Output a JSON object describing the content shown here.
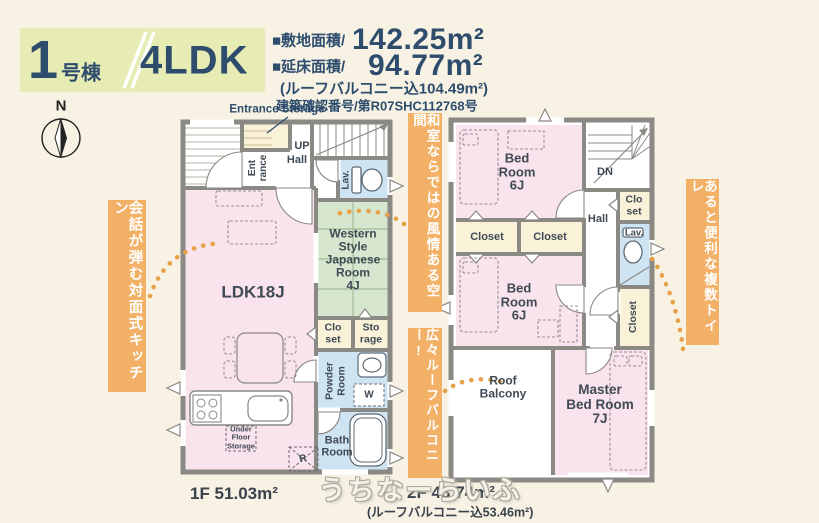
{
  "colors": {
    "background": "#f7f2e4",
    "header_green": "#e7ecb5",
    "navy": "#2e4d6d",
    "room_pink": "#f9e3ed",
    "tatami_green": "#d7e6cf",
    "wet_blue": "#cfe4f3",
    "closet_cream": "#f9f2d9",
    "wall_gray": "#8b8984",
    "banner_orange": "#f2b166",
    "dot_orange": "#e7a149"
  },
  "header": {
    "unit_number": "1",
    "unit_suffix": "号棟",
    "layout": "4LDK",
    "land_label": "■敷地面積/",
    "land_value": "142.25m²",
    "floor_label": "■延床面積/",
    "floor_value": "94.77m²",
    "balcony_note": "(ルーフバルコニー込104.49m²)",
    "permit": "建築確認番号/第R07SHC112768号"
  },
  "compass_label": "N",
  "banners": {
    "kitchen": "会話が弾む対面式キッチン",
    "washitsu": "和室ならではの風情ある空間",
    "balcony": "広々ルーフバルコニー!",
    "toilet": "あると便利な複数トイレ"
  },
  "floor1": {
    "area_label": "1F 51.03m²",
    "labels": {
      "entrance_storage": "Entrance Storage",
      "entrance": "Ent\nrance",
      "up": "UP",
      "hall": "Hall",
      "lav": "Lav.",
      "ldk": "LDK18J",
      "japanese_room": "Western\nStyle\nJapanese\nRoom\n4J",
      "closet": "Clo\nset",
      "storage": "Sto\nrage",
      "powder_room": "Powder\nRoom",
      "washer": "W",
      "bath_room": "Bath\nRoom",
      "under_floor_storage": "Under\nFloor\nStorage",
      "fridge": "R"
    }
  },
  "floor2": {
    "area_label": "2F 43.74m²",
    "area_note": "(ルーフバルコニー込53.46m²)",
    "labels": {
      "bedroom1": "Bed\nRoom\n6J",
      "dn": "DN",
      "closet_small": "Clo\nset",
      "hall": "Hall",
      "lav": "Lav.",
      "closet_a": "Closet",
      "closet_b": "Closet",
      "bedroom2": "Bed\nRoom\n6J",
      "closet_vertical": "Closet",
      "roof_balcony": "Roof\nBalcony",
      "master_bedroom": "Master\nBed Room\n7J"
    }
  },
  "watermark": "うちなーらいふ"
}
